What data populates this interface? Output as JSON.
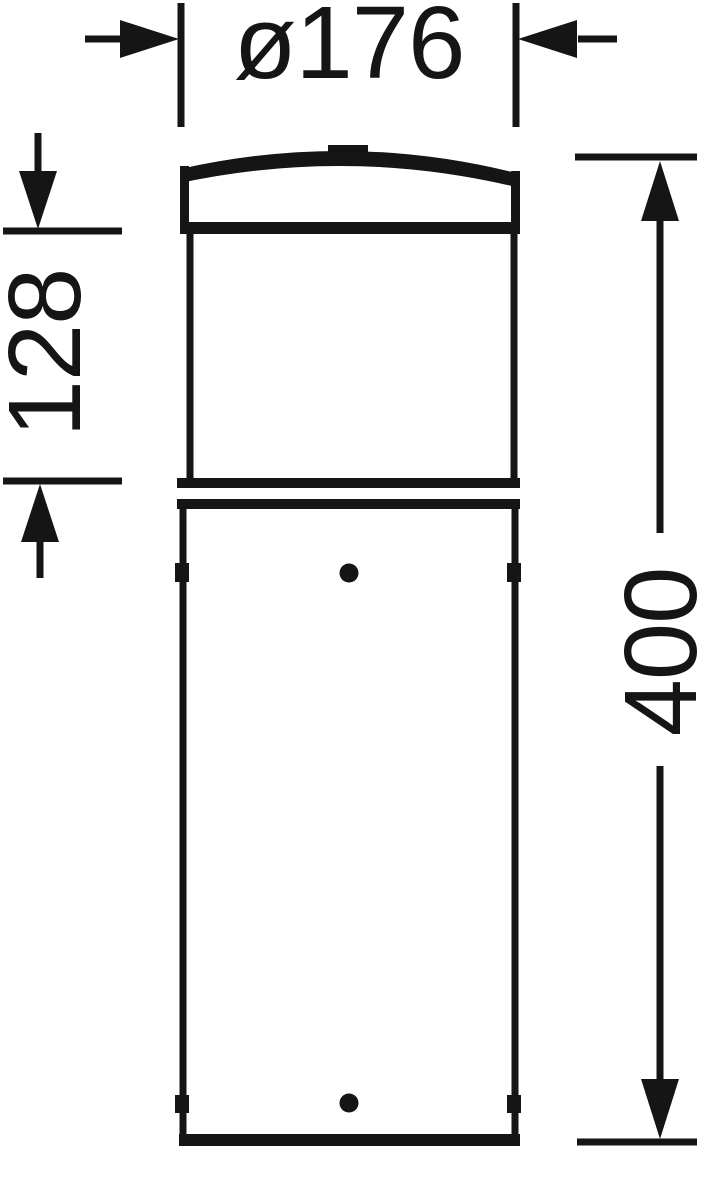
{
  "figure": {
    "title": "bollard-luminaire-dimension-drawing",
    "background_color": "#ffffff",
    "line_color": "#151515",
    "labels": {
      "diameter": "ø176",
      "upper_section_height": "128",
      "total_height": "400"
    }
  }
}
